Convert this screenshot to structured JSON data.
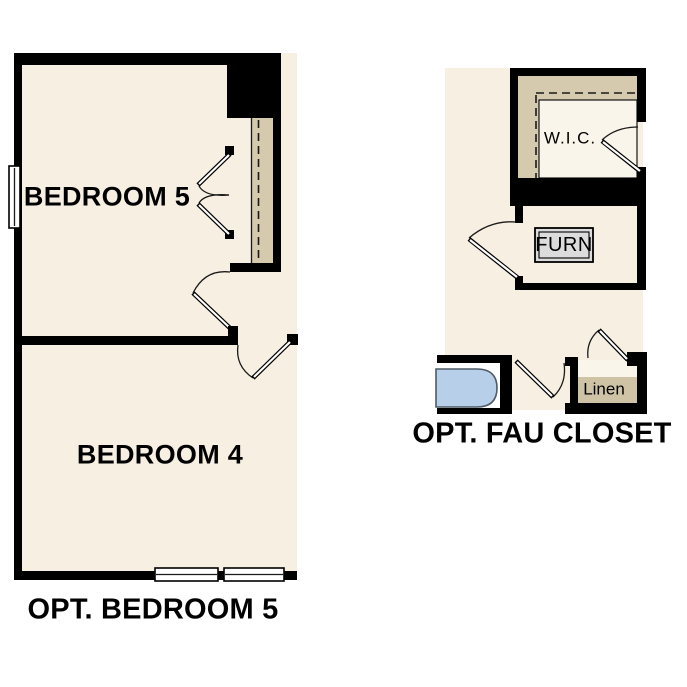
{
  "colors": {
    "bg": "#ffffff",
    "wall": "#000000",
    "floor": "#f6efe2",
    "shelf": "#d5c9ae",
    "linen_shelf": "#cfc3a6",
    "closet_inner": "#faf5ea",
    "tub": "#b7cfe9",
    "tub_border": "#4e5a66",
    "furn_fill": "#dcdcdc",
    "line": "#1a1a1a",
    "text": "#000000"
  },
  "plans": {
    "opt_bedroom5": {
      "title": "OPT. BEDROOM 5",
      "room1": "BEDROOM 5",
      "room2": "BEDROOM 4"
    },
    "opt_fau_closet": {
      "title": "OPT. FAU CLOSET",
      "wic": "W.I.C.",
      "furn": "FURN",
      "linen": "Linen"
    }
  }
}
